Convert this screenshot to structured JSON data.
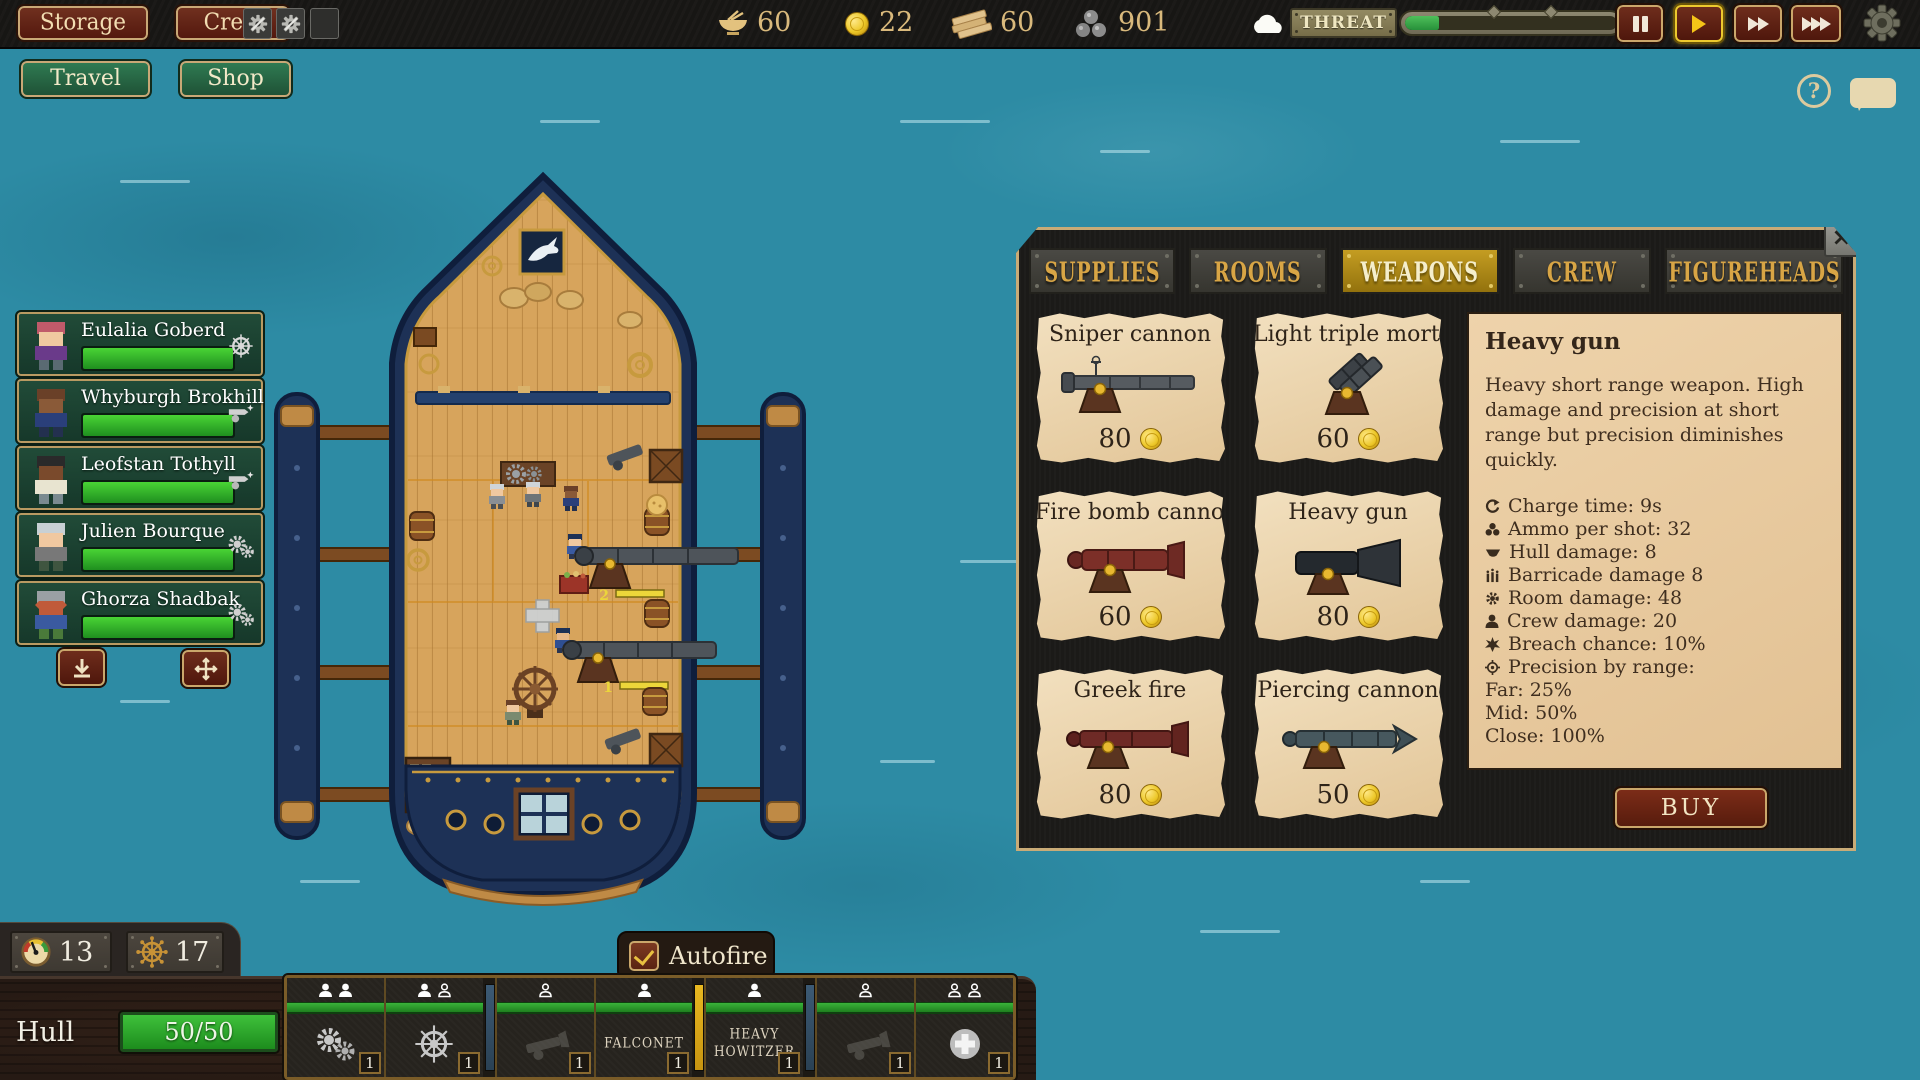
{
  "colors": {
    "water": "#2d8ba4",
    "gold_accent": "#d8a545",
    "parchment": "#e9d2ab",
    "panel_charcoal": "#1b1a18",
    "wood_button": "#5f2318",
    "threat_green": "#3aa53a",
    "health_green": "#2fbf2f",
    "buy_tab_green": "#2f7d4a",
    "upgrade_tab_blue": "#2b5064",
    "sell_tab_brown": "#5e3b27"
  },
  "top_bar": {
    "storage_label": "Storage",
    "crew_label": "Crew",
    "resources": [
      {
        "icon": "food-bowl-icon",
        "value": "60"
      },
      {
        "icon": "gold-coin-icon",
        "value": "22"
      },
      {
        "icon": "wood-planks-icon",
        "value": "60"
      },
      {
        "icon": "cannonball-icon",
        "value": "901"
      }
    ],
    "threat_label": "THREAT",
    "threat_percent": 16,
    "speed_controls": {
      "active": "play"
    }
  },
  "nav": {
    "travel_label": "Travel",
    "shop_label": "Shop"
  },
  "crew_list": [
    {
      "name": "Eulalia Goberd",
      "health_percent": 100,
      "role_icon": "ship-wheel-icon"
    },
    {
      "name": "Whyburgh Brokhill",
      "health_percent": 100,
      "role_icon": "cannon-icon"
    },
    {
      "name": "Leofstan Tothyll",
      "health_percent": 100,
      "role_icon": "cannon-icon"
    },
    {
      "name": "Julien Bourque",
      "health_percent": 100,
      "role_icon": "gears-icon"
    },
    {
      "name": "Ghorza Shadbak",
      "health_percent": 100,
      "role_icon": "gears-icon"
    }
  ],
  "ship": {
    "flag_icon": "marlin-flag-icon",
    "cannon_charge_labels": [
      "2",
      "1"
    ]
  },
  "shop": {
    "close_label": "×",
    "tabs": [
      {
        "label": "SUPPLIES",
        "active": false
      },
      {
        "label": "ROOMS",
        "active": false
      },
      {
        "label": "WEAPONS",
        "active": true
      },
      {
        "label": "CREW",
        "active": false
      },
      {
        "label": "FIGUREHEADS",
        "active": false
      }
    ],
    "side_tabs": [
      {
        "label": "BUY",
        "active": true
      },
      {
        "label": "UPGRADE",
        "active": false
      },
      {
        "label": "SELL",
        "active": false
      }
    ],
    "items": [
      {
        "name": "Sniper cannon",
        "price": "80",
        "selected": false
      },
      {
        "name": "Light triple mortar",
        "price": "60",
        "selected": false
      },
      {
        "name": "Fire bomb cannon",
        "price": "60",
        "selected": false
      },
      {
        "name": "Heavy gun",
        "price": "80",
        "selected": true
      },
      {
        "name": "Greek fire",
        "price": "80",
        "selected": false
      },
      {
        "name": "Piercing cannon",
        "price": "50",
        "selected": false
      }
    ],
    "detail": {
      "title": "Heavy gun",
      "description": "Heavy short range weapon. High damage and precision at short range but precision diminishes quickly.",
      "stats": [
        {
          "icon": "charge-time-icon",
          "text": "Charge time: 9s"
        },
        {
          "icon": "ammo-icon",
          "text": "Ammo per shot: 32"
        },
        {
          "icon": "hull-damage-icon",
          "text": "Hull damage: 8"
        },
        {
          "icon": "barricade-damage-icon",
          "text": "Barricade damage 8"
        },
        {
          "icon": "room-damage-icon",
          "text": "Room damage: 48"
        },
        {
          "icon": "crew-damage-icon",
          "text": "Crew damage: 20"
        },
        {
          "icon": "breach-chance-icon",
          "text": "Breach chance: 10%"
        },
        {
          "icon": "precision-icon",
          "text": "Precision by range:"
        }
      ],
      "ranges": [
        "Far: 25%",
        "Mid: 50%",
        "Close: 100%"
      ],
      "buy_label": "BUY"
    }
  },
  "bottom": {
    "stats": [
      {
        "icon": "gauge-icon",
        "value": "13"
      },
      {
        "icon": "ship-wheel-icon",
        "value": "17"
      }
    ],
    "hull_label": "Hull",
    "hull_value": "50/50",
    "hull_percent": 100,
    "autofire_label": "Autofire",
    "autofire_checked": true,
    "slots": [
      {
        "crew": [
          "filled",
          "filled"
        ],
        "icon": "gears-icon",
        "count": "1"
      },
      {
        "crew": [
          "filled",
          "empty"
        ],
        "icon": "ship-wheel-icon",
        "count": "1"
      },
      {
        "crew": [
          "empty"
        ],
        "icon": "cannon-ghost-icon",
        "count": "1",
        "separator_before": "blue"
      },
      {
        "crew": [
          "filled"
        ],
        "label": "FALCONET",
        "count": "1"
      },
      {
        "crew": [
          "filled"
        ],
        "label": "HEAVY HOWITZER",
        "count": "1",
        "separator_before": "yellow"
      },
      {
        "crew": [
          "empty"
        ],
        "icon": "cannon-ghost-icon",
        "count": "1",
        "separator_before": "blue"
      },
      {
        "crew": [
          "empty",
          "empty"
        ],
        "icon": "add-crew-icon",
        "count": "1"
      }
    ]
  },
  "help": {
    "help_label": "?"
  }
}
